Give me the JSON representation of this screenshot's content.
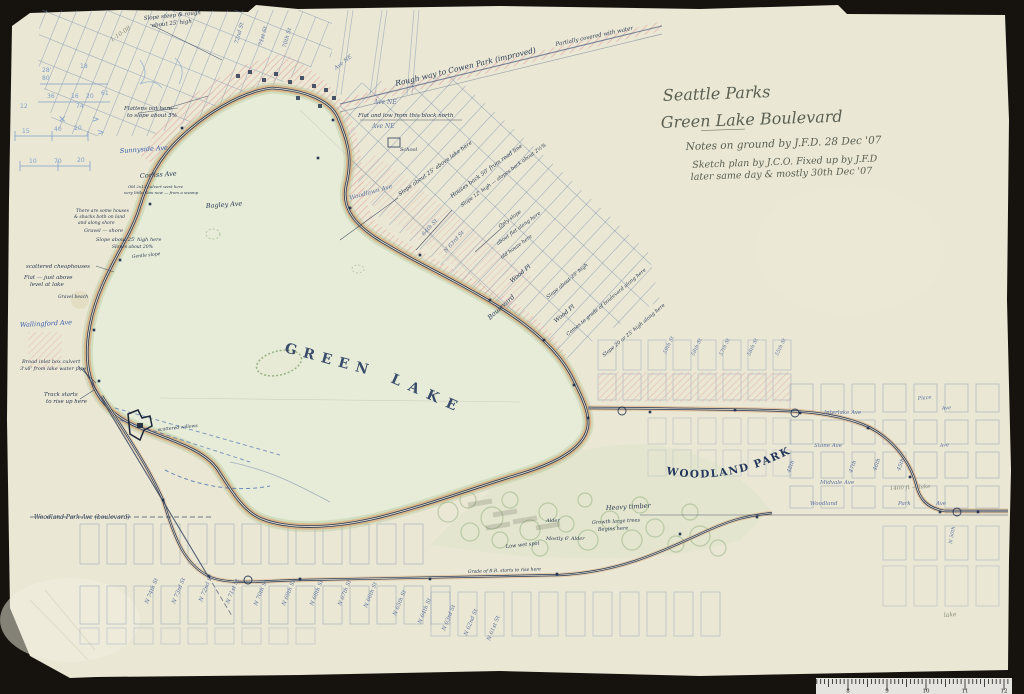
{
  "photo": {
    "backdrop_color": "#16130e",
    "paper_color": "#eae7d4",
    "ruler_numbers": [
      "8",
      "9",
      "10",
      "11",
      "12"
    ]
  },
  "title_block": {
    "line1": "Seattle Parks",
    "line2": "Green Lake Boulevard",
    "line3": "Notes on ground by J.F.D.  28 Dec '07",
    "line4": "Sketch plan by J.C.O.  Fixed up by J.F.D",
    "line5": "later same day & mostly 30th Dec '07"
  },
  "map": {
    "lake_label": {
      "word1": "GREEN",
      "word2": "LAKE"
    },
    "park_label": "WOODLAND PARK",
    "colors": {
      "ink": "#2c3a55",
      "navy_line": "#1f3050",
      "grid_blue": "#7389ad",
      "pink": "#e4a7a3",
      "road_tan": "#d8ae7e",
      "yellow": "#e3c84b",
      "green": "#a3bf8c",
      "pencil_blue": "#7fa0cc",
      "graphite": "#8a8d7c"
    },
    "annotations": [
      {
        "t": "Rough way to Cowen Park (improved)",
        "x": 396,
        "y": 86,
        "r": -13.5,
        "s": 7.5,
        "k": "ink"
      },
      {
        "t": "Partially covered with water",
        "x": 556,
        "y": 46,
        "r": -12,
        "s": 5.5,
        "k": "ink"
      },
      {
        "t": "72nd St",
        "x": 238,
        "y": 44,
        "r": -75,
        "s": 5.5,
        "k": "street"
      },
      {
        "t": "71st St",
        "x": 262,
        "y": 46,
        "r": -75,
        "s": 5.5,
        "k": "street"
      },
      {
        "t": "70th St",
        "x": 286,
        "y": 48,
        "r": -75,
        "s": 5.5,
        "k": "street"
      },
      {
        "t": "Ave NE",
        "x": 336,
        "y": 70,
        "r": -38,
        "s": 5.5,
        "k": "street"
      },
      {
        "t": "Ave NE",
        "x": 374,
        "y": 104,
        "r": 0,
        "s": 6,
        "k": "street"
      },
      {
        "t": "Ave NE",
        "x": 372,
        "y": 128,
        "r": 0,
        "s": 6,
        "k": "street"
      },
      {
        "t": "Flat and low from this block north",
        "x": 358,
        "y": 117,
        "r": 0,
        "s": 5.5,
        "k": "ink"
      },
      {
        "t": "School",
        "x": 400,
        "y": 151,
        "r": 0,
        "s": 5,
        "k": "ink"
      },
      {
        "t": "Slope about 25' above lake here",
        "x": 400,
        "y": 196,
        "r": -36,
        "s": 5.5,
        "k": "ink"
      },
      {
        "t": "Houses back 50' from road line",
        "x": 452,
        "y": 198,
        "r": -36,
        "s": 5.5,
        "k": "ink"
      },
      {
        "t": "Slope 12' high — slopes back about 2½%",
        "x": 462,
        "y": 207,
        "r": -36,
        "s": 5,
        "k": "ink"
      },
      {
        "t": "Woodlawn Ave",
        "x": 350,
        "y": 200,
        "r": -16,
        "s": 6,
        "k": "street"
      },
      {
        "t": "64th St",
        "x": 424,
        "y": 236,
        "r": -48,
        "s": 5.5,
        "k": "street"
      },
      {
        "t": "N 63rd St",
        "x": 446,
        "y": 253,
        "r": -48,
        "s": 5.5,
        "k": "street"
      },
      {
        "t": "Only slope",
        "x": 500,
        "y": 228,
        "r": -36,
        "s": 5,
        "k": "ink"
      },
      {
        "t": "about flat along here",
        "x": 498,
        "y": 245,
        "r": -36,
        "s": 5,
        "k": "ink"
      },
      {
        "t": "old house here",
        "x": 502,
        "y": 259,
        "r": -36,
        "s": 5,
        "k": "ink"
      },
      {
        "t": "Wood Pl",
        "x": 512,
        "y": 283,
        "r": -40,
        "s": 6,
        "k": "ink"
      },
      {
        "t": "Wood Pl",
        "x": 556,
        "y": 323,
        "r": -40,
        "s": 6,
        "k": "ink"
      },
      {
        "t": "Boulevard",
        "x": 490,
        "y": 320,
        "r": -42,
        "s": 6.5,
        "k": "ink"
      },
      {
        "t": "Slope about 25' high",
        "x": 548,
        "y": 299,
        "r": -40,
        "s": 5,
        "k": "ink"
      },
      {
        "t": "Comes to grade of boulevard along here",
        "x": 568,
        "y": 336,
        "r": -40,
        "s": 5,
        "k": "ink"
      },
      {
        "t": "Slope 20 or 25' high along here",
        "x": 604,
        "y": 357,
        "r": -40,
        "s": 5,
        "k": "ink"
      },
      {
        "t": "Slope steep & rough",
        "x": 144,
        "y": 20,
        "r": -6,
        "s": 5.5,
        "k": "ink"
      },
      {
        "t": "about 25' high",
        "x": 152,
        "y": 27,
        "r": -6,
        "s": 5.5,
        "k": "ink"
      },
      {
        "t": "Flattens out here",
        "x": 124,
        "y": 110,
        "r": 0,
        "s": 5.5,
        "k": "ink"
      },
      {
        "t": "to slope about 5%",
        "x": 127,
        "y": 117,
        "r": 0,
        "s": 5.5,
        "k": "ink"
      },
      {
        "t": "Sunnyside Ave",
        "x": 120,
        "y": 153,
        "r": -4,
        "s": 6.5,
        "k": "blue"
      },
      {
        "t": "Corliss Ave",
        "x": 140,
        "y": 178,
        "r": -4,
        "s": 6.5,
        "k": "ink"
      },
      {
        "t": "Old 2x12 culvert west here",
        "x": 128,
        "y": 188,
        "r": 0,
        "s": 4,
        "k": "ink"
      },
      {
        "t": "very little flow now — from a swamp",
        "x": 124,
        "y": 194,
        "r": 0,
        "s": 4,
        "k": "ink"
      },
      {
        "t": "Bagley Ave",
        "x": 206,
        "y": 208,
        "r": -4,
        "s": 6.5,
        "k": "ink"
      },
      {
        "t": "There are some houses",
        "x": 76,
        "y": 212,
        "r": 0,
        "s": 4.5,
        "k": "ink"
      },
      {
        "t": "& shacks both on land",
        "x": 74,
        "y": 218,
        "r": 0,
        "s": 4.5,
        "k": "ink"
      },
      {
        "t": "and along shore",
        "x": 78,
        "y": 224,
        "r": 0,
        "s": 4.5,
        "k": "ink"
      },
      {
        "t": "Gravel — shore",
        "x": 84,
        "y": 232,
        "r": 0,
        "s": 5,
        "k": "ink"
      },
      {
        "t": "Slope about 25' high here",
        "x": 96,
        "y": 241,
        "r": 0,
        "s": 5,
        "k": "ink"
      },
      {
        "t": "Slopes about 20%",
        "x": 112,
        "y": 248,
        "r": 0,
        "s": 4.5,
        "k": "ink"
      },
      {
        "t": "Gentle slope",
        "x": 132,
        "y": 258,
        "r": -6,
        "s": 4.5,
        "k": "ink"
      },
      {
        "t": "scattered cheaphouses",
        "x": 26,
        "y": 268,
        "r": 0,
        "s": 5.5,
        "k": "ink"
      },
      {
        "t": "Flat — just above",
        "x": 24,
        "y": 279,
        "r": 0,
        "s": 5.5,
        "k": "ink"
      },
      {
        "t": "level at lake",
        "x": 30,
        "y": 286,
        "r": 0,
        "s": 5.5,
        "k": "ink"
      },
      {
        "t": "Gravel beach",
        "x": 58,
        "y": 298,
        "r": 0,
        "s": 4.5,
        "k": "ink"
      },
      {
        "t": "Wallingford Ave",
        "x": 20,
        "y": 327,
        "r": -3,
        "s": 6.5,
        "k": "blue"
      },
      {
        "t": "Broad inlet box culvert",
        "x": 22,
        "y": 363,
        "r": 0,
        "s": 5,
        "k": "ink"
      },
      {
        "t": "3'x6' from lake water pipe",
        "x": 20,
        "y": 370,
        "r": 0,
        "s": 5,
        "k": "ink"
      },
      {
        "t": "Track starts",
        "x": 44,
        "y": 396,
        "r": 0,
        "s": 5.5,
        "k": "ink"
      },
      {
        "t": "to rise up here",
        "x": 46,
        "y": 403,
        "r": 0,
        "s": 5.5,
        "k": "ink"
      },
      {
        "t": "scattered willows",
        "x": 158,
        "y": 431,
        "r": -6,
        "s": 4.5,
        "k": "ink"
      },
      {
        "t": "Woodland Park Ave (boulevard)",
        "x": 34,
        "y": 519,
        "r": 0,
        "s": 6,
        "k": "ink"
      },
      {
        "t": "Low wet spot",
        "x": 506,
        "y": 548,
        "r": -6,
        "s": 5,
        "k": "ink"
      },
      {
        "t": "Alder",
        "x": 546,
        "y": 522,
        "r": 0,
        "s": 5,
        "k": "ink"
      },
      {
        "t": "Mostly 6' Alder",
        "x": 546,
        "y": 540,
        "r": 0,
        "s": 5,
        "k": "ink"
      },
      {
        "t": "Heavy timber",
        "x": 606,
        "y": 510,
        "r": -3,
        "s": 6.5,
        "k": "ink"
      },
      {
        "t": "Growth large trees",
        "x": 592,
        "y": 524,
        "r": -3,
        "s": 5,
        "k": "ink"
      },
      {
        "t": "Begins here",
        "x": 598,
        "y": 531,
        "r": -3,
        "s": 5,
        "k": "ink"
      },
      {
        "t": "Grade of R.R. starts to rise here",
        "x": 468,
        "y": 573,
        "r": -2,
        "s": 4.5,
        "k": "ink"
      },
      {
        "t": "N 74th St",
        "x": 148,
        "y": 604,
        "r": -68,
        "s": 5.5,
        "k": "street"
      },
      {
        "t": "N 73rd St",
        "x": 175,
        "y": 604,
        "r": -68,
        "s": 5.5,
        "k": "street"
      },
      {
        "t": "N 72nd St",
        "x": 202,
        "y": 602,
        "r": -68,
        "s": 5.5,
        "k": "street"
      },
      {
        "t": "N 71st St",
        "x": 229,
        "y": 604,
        "r": -68,
        "s": 5.5,
        "k": "street"
      },
      {
        "t": "N 70th St",
        "x": 257,
        "y": 606,
        "r": -68,
        "s": 5.5,
        "k": "street"
      },
      {
        "t": "N 69th St",
        "x": 285,
        "y": 606,
        "r": -68,
        "s": 5.5,
        "k": "street"
      },
      {
        "t": "N 68th St",
        "x": 313,
        "y": 606,
        "r": -68,
        "s": 5.5,
        "k": "street"
      },
      {
        "t": "N 67th St",
        "x": 341,
        "y": 606,
        "r": -68,
        "s": 5.5,
        "k": "street"
      },
      {
        "t": "N 66th St",
        "x": 367,
        "y": 608,
        "r": -68,
        "s": 5.5,
        "k": "street"
      },
      {
        "t": "N 65th St",
        "x": 396,
        "y": 616,
        "r": -68,
        "s": 5.5,
        "k": "street"
      },
      {
        "t": "N 64th St",
        "x": 421,
        "y": 624,
        "r": -68,
        "s": 5.5,
        "k": "street"
      },
      {
        "t": "N 63rd St",
        "x": 445,
        "y": 631,
        "r": -68,
        "s": 5.5,
        "k": "street"
      },
      {
        "t": "N 62nd St",
        "x": 467,
        "y": 636,
        "r": -68,
        "s": 5.5,
        "k": "street"
      },
      {
        "t": "N 61st St",
        "x": 490,
        "y": 641,
        "r": -68,
        "s": 5.5,
        "k": "street"
      },
      {
        "t": "Interlake Ave",
        "x": 824,
        "y": 414,
        "r": 0,
        "s": 5.5,
        "k": "street"
      },
      {
        "t": "Stone Ave",
        "x": 814,
        "y": 447,
        "r": 0,
        "s": 5.5,
        "k": "street"
      },
      {
        "t": "Midvale Ave",
        "x": 820,
        "y": 484,
        "r": 0,
        "s": 5.5,
        "k": "street"
      },
      {
        "t": "Woodland",
        "x": 810,
        "y": 505,
        "r": 0,
        "s": 5.5,
        "k": "street"
      },
      {
        "t": "Park",
        "x": 898,
        "y": 505,
        "r": 0,
        "s": 5.5,
        "k": "street"
      },
      {
        "t": "Ave",
        "x": 936,
        "y": 505,
        "r": 0,
        "s": 5.5,
        "k": "street"
      },
      {
        "t": "48th",
        "x": 790,
        "y": 473,
        "r": -70,
        "s": 5.5,
        "k": "street"
      },
      {
        "t": "47th",
        "x": 852,
        "y": 473,
        "r": -70,
        "s": 5.5,
        "k": "street"
      },
      {
        "t": "46th",
        "x": 876,
        "y": 471,
        "r": -70,
        "s": 5.5,
        "k": "street"
      },
      {
        "t": "45th",
        "x": 900,
        "y": 471,
        "r": -70,
        "s": 5.5,
        "k": "street"
      },
      {
        "t": "Place",
        "x": 918,
        "y": 400,
        "r": -6,
        "s": 5,
        "k": "street"
      },
      {
        "t": "Ave",
        "x": 942,
        "y": 410,
        "r": -6,
        "s": 5,
        "k": "street"
      },
      {
        "t": "Ave",
        "x": 940,
        "y": 447,
        "r": -6,
        "s": 5,
        "k": "street"
      },
      {
        "t": "59th St",
        "x": 666,
        "y": 354,
        "r": -65,
        "s": 5,
        "k": "street"
      },
      {
        "t": "58th St",
        "x": 694,
        "y": 356,
        "r": -65,
        "s": 5,
        "k": "street"
      },
      {
        "t": "57th St",
        "x": 722,
        "y": 356,
        "r": -65,
        "s": 5,
        "k": "street"
      },
      {
        "t": "56th St",
        "x": 750,
        "y": 356,
        "r": -65,
        "s": 5,
        "k": "street"
      },
      {
        "t": "55th St",
        "x": 778,
        "y": 356,
        "r": -65,
        "s": 5,
        "k": "street"
      },
      {
        "t": "N 50th",
        "x": 952,
        "y": 544,
        "r": -80,
        "s": 5,
        "k": "street"
      },
      {
        "t": "28'",
        "x": 42,
        "y": 72,
        "r": 0,
        "s": 6,
        "k": "pencil"
      },
      {
        "t": "80",
        "x": 42,
        "y": 80,
        "r": 0,
        "s": 6,
        "k": "pencil"
      },
      {
        "t": "18",
        "x": 80,
        "y": 68,
        "r": 0,
        "s": 6,
        "k": "pencil"
      },
      {
        "t": "36",
        "x": 47,
        "y": 98,
        "r": 0,
        "s": 6,
        "k": "pencil"
      },
      {
        "t": "16",
        "x": 71,
        "y": 98,
        "r": 0,
        "s": 6,
        "k": "pencil"
      },
      {
        "t": "20",
        "x": 86,
        "y": 98,
        "r": 0,
        "s": 6,
        "k": "pencil"
      },
      {
        "t": "61",
        "x": 101,
        "y": 95,
        "r": 0,
        "s": 6,
        "k": "pencil"
      },
      {
        "t": "74",
        "x": 76,
        "y": 108,
        "r": 0,
        "s": 6,
        "k": "pencil"
      },
      {
        "t": "12",
        "x": 20,
        "y": 108,
        "r": 0,
        "s": 6,
        "k": "pencil"
      },
      {
        "t": "15",
        "x": 22,
        "y": 133,
        "r": 0,
        "s": 6,
        "k": "pencil"
      },
      {
        "t": "40",
        "x": 54,
        "y": 131,
        "r": 0,
        "s": 6,
        "k": "pencil"
      },
      {
        "t": "20",
        "x": 74,
        "y": 130,
        "r": 0,
        "s": 6,
        "k": "pencil"
      },
      {
        "t": "10",
        "x": 29,
        "y": 163,
        "r": 0,
        "s": 6,
        "k": "pencil"
      },
      {
        "t": "70",
        "x": 54,
        "y": 163,
        "r": 0,
        "s": 6,
        "k": "pencil"
      },
      {
        "t": "20",
        "x": 77,
        "y": 162,
        "r": 0,
        "s": 6,
        "k": "pencil"
      },
      {
        "t": "×",
        "x": 58,
        "y": 122,
        "r": 0,
        "s": 10,
        "k": "pencil"
      },
      {
        "t": ">",
        "x": 92,
        "y": 122,
        "r": 0,
        "s": 9,
        "k": "pencil"
      },
      {
        "t": ">",
        "x": 97,
        "y": 135,
        "r": 0,
        "s": 9,
        "k": "pencil"
      },
      {
        "t": "1-10-08",
        "x": 112,
        "y": 42,
        "r": -35,
        "s": 6,
        "k": "graphite"
      },
      {
        "t": "1400 ft — lake",
        "x": 890,
        "y": 490,
        "r": -3,
        "s": 5.5,
        "k": "graphite"
      },
      {
        "t": "lake",
        "x": 944,
        "y": 617,
        "r": -5,
        "s": 6,
        "k": "graphite"
      }
    ]
  }
}
